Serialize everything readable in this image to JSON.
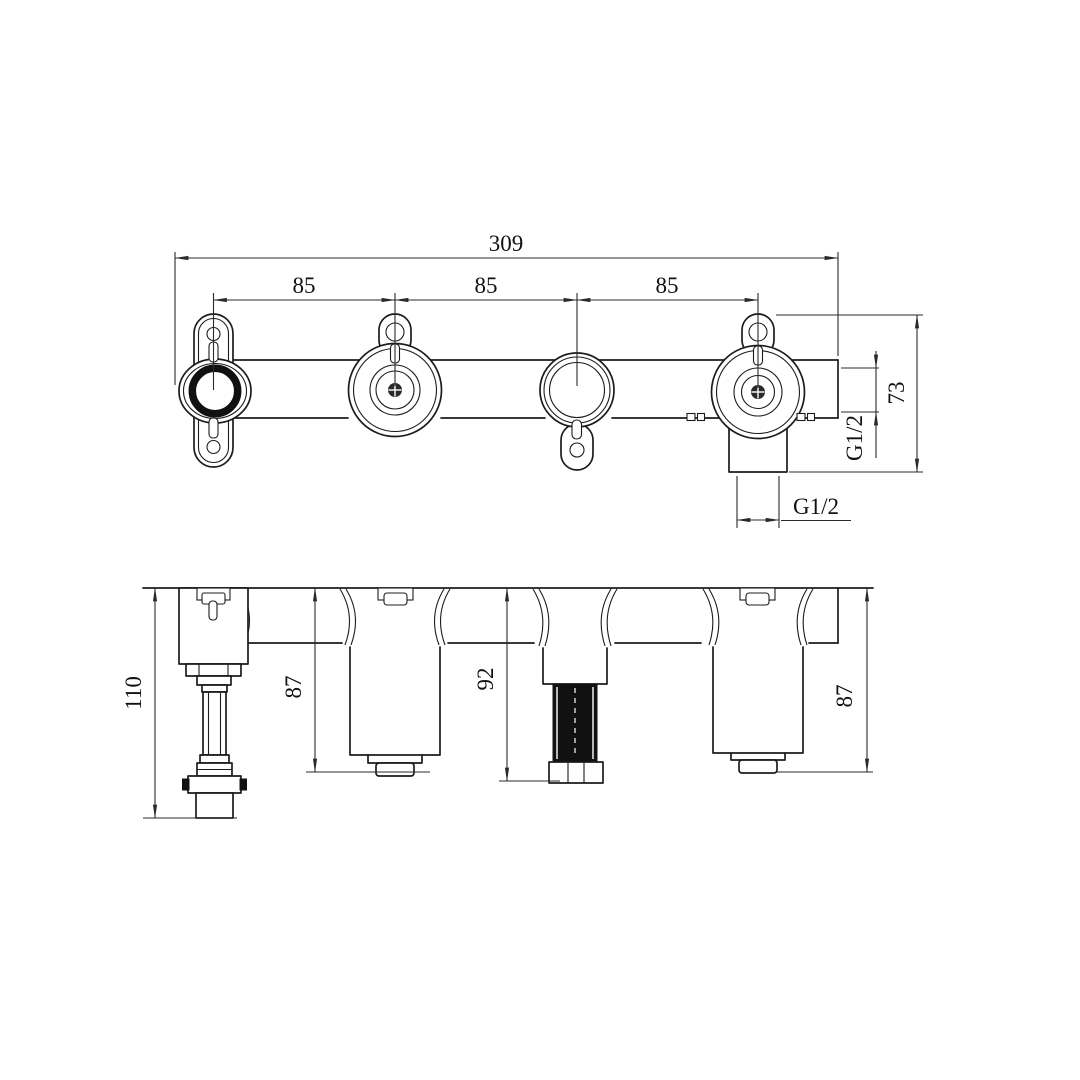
{
  "dims": {
    "front": {
      "total": "309",
      "s1": "85",
      "s2": "85",
      "s3": "85",
      "depth": "73",
      "side_port": "G1/2",
      "bottom_port": "G1/2"
    },
    "side": {
      "overall": "110",
      "left": "87",
      "center": "92",
      "right": "87"
    }
  },
  "colors": {
    "line": "#1c1c1c",
    "background": "#ffffff"
  }
}
